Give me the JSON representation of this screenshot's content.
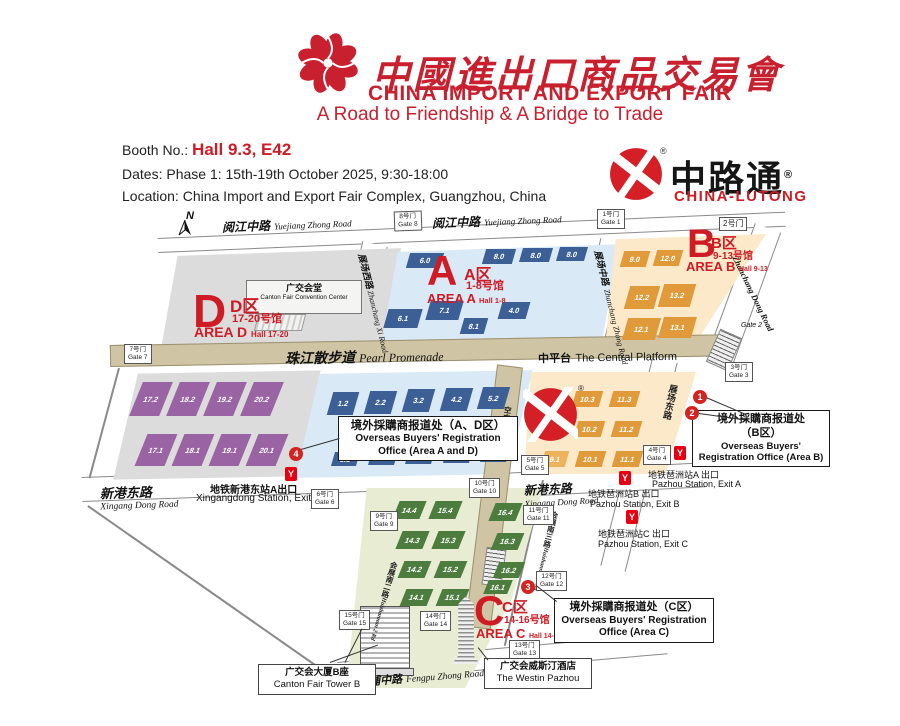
{
  "header": {
    "cn_title": "中國進出口商品交易會",
    "en_title": "CHINA IMPORT AND EXPORT FAIR",
    "slogan": "A Road to Friendship & A Bridge to Trade"
  },
  "info": {
    "booth_label": "Booth No.:",
    "booth_value": "Hall 9.3, E42",
    "dates": "Dates: Phase 1: 15th-19th October 2025, 9:30-18:00",
    "location": "Location: China Import and Export Fair Complex, Guangzhou, China"
  },
  "brand": {
    "cn": "中路通",
    "en": "CHINA-LUTONG",
    "reg": "®"
  },
  "map": {
    "compass": "N",
    "roads": {
      "yuejiang_cn": "阅江中路",
      "yuejiang_en": "Yuejiang Zhong Road",
      "promenade_cn": "珠江散步道",
      "promenade_en": "Pearl Promenade",
      "platform_cn": "中平台",
      "platform_en": "The Central Platform",
      "xingang_cn": "新港东路",
      "xingang_en": "Xingang Dong Road",
      "fengpu_cn": "凤浦中路",
      "fengpu_en": "Fengpu Zhong Road",
      "zx_cn": "展场西路",
      "zx_en": "Zhanchang Xi Road",
      "zz_cn": "展场中路",
      "zz_en": "Zhanchang Zhong Road",
      "zd_cn": "展场东路",
      "zd_en": "Zhanchang Dong Road",
      "flyover_cn": "空中走廊",
      "flyover_en": "Flyover",
      "hz2_cn": "会展南二路",
      "hz2_en": "Huizhannan 2 Rd",
      "hz3_cn": "会展南三路",
      "hz3_en": "Huizhannan 3 Rd"
    },
    "areas": {
      "a": {
        "letter": "A",
        "zone": "A区",
        "halls": "1-8号馆",
        "name": "AREA A",
        "range": "Hall 1-8"
      },
      "b": {
        "letter": "B",
        "zone": "B区",
        "halls": "9-13号馆",
        "name": "AREA B",
        "range": "Hall 9-13"
      },
      "c": {
        "letter": "C",
        "zone": "C区",
        "halls": "14-16号馆",
        "name": "AREA C",
        "range": "Hall 14-16"
      },
      "d": {
        "letter": "D",
        "zone": "D区",
        "halls": "17-20号馆",
        "name": "AREA D",
        "range": "Hall 17-20"
      }
    },
    "halls": {
      "a": [
        "6.0",
        "8.0",
        "8.0",
        "8.0",
        "6.1",
        "7.1",
        "8.1",
        "4.0",
        "1.2",
        "2.2",
        "3.2",
        "4.2",
        "5.2",
        "1.1",
        "2.1",
        "3.1",
        "4.1",
        "5.1"
      ],
      "b": [
        "9.0",
        "12.0",
        "12.2",
        "13.2",
        "12.1",
        "13.1",
        "9.3",
        "10.3",
        "11.3",
        "9.2",
        "10.2",
        "11.2",
        "9.1",
        "10.1",
        "11.1"
      ],
      "c": [
        "14.4",
        "15.4",
        "16.4",
        "14.3",
        "15.3",
        "16.3",
        "14.2",
        "15.2",
        "16.2",
        "14.1",
        "15.1",
        "16.1"
      ],
      "d": [
        "17.2",
        "18.2",
        "19.2",
        "20.2",
        "17.1",
        "18.1",
        "19.1",
        "20.1"
      ]
    },
    "gates": {
      "g1": {
        "cn": "1号门",
        "en": "Gate 1"
      },
      "g2": {
        "cn": "2号门",
        "en": "Gate 2"
      },
      "g3": {
        "cn": "3号门",
        "en": "Gate 3"
      },
      "g4": {
        "cn": "4号门",
        "en": "Gate 4"
      },
      "g5": {
        "cn": "5号门",
        "en": "Gate 5"
      },
      "g6": {
        "cn": "6号门",
        "en": "Gate 6"
      },
      "g7": {
        "cn": "7号门",
        "en": "Gate 7"
      },
      "g8": {
        "cn": "8号门",
        "en": "Gate 8"
      },
      "g9": {
        "cn": "9号门",
        "en": "Gate 9"
      },
      "g10": {
        "cn": "10号门",
        "en": "Gate 10"
      },
      "g11": {
        "cn": "11号门",
        "en": "Gate 11"
      },
      "g12": {
        "cn": "12号门",
        "en": "Gate 12"
      },
      "g13": {
        "cn": "13号门",
        "en": "Gate 13"
      },
      "g14": {
        "cn": "14号门",
        "en": "Gate 14"
      },
      "g15": {
        "cn": "15号门",
        "en": "Gate 15"
      }
    },
    "buildings": {
      "convention_cn": "广交会堂",
      "convention_en": "Canton Fair Convention Center",
      "tower_b_cn": "广交会大厦B座",
      "tower_b_en": "Canton Fair Tower B",
      "westin_cn": "广交会威斯汀酒店",
      "westin_en": "The Westin Pazhou"
    },
    "registration": {
      "ad_cn": "境外採購商报道处（A、D区）",
      "ad_en1": "Overseas Buyers' Registration",
      "ad_en2": "Office (Area A and D)",
      "b_cn": "境外採購商报道处",
      "b_cn2": "（B区）",
      "b_en1": "Overseas Buyers'",
      "b_en2": "Registration Office (Area B)",
      "c_cn": "境外採購商报道处（C区）",
      "c_en1": "Overseas Buyers' Registration",
      "c_en2": "Office (Area C)"
    },
    "metro": {
      "glyph": "Y",
      "xingang_cn": "地铁新港东站A出口",
      "xingang_en": "Xingangdong Station, Exit A",
      "pa_cn": "地铁琶洲站A 出口",
      "pa_en": "Pazhou Station, Exit A",
      "pb_cn": "地铁琶洲站B 出口",
      "pb_en": "Pazhou Station, Exit B",
      "pc_cn": "地铁琶洲站C 出口",
      "pc_en": "Pazhou Station, Exit C"
    },
    "markers": {
      "m1": "1",
      "m2": "2",
      "m3": "3",
      "m4": "4"
    }
  },
  "colors": {
    "accent": "#cf1b24",
    "hall_a": "#3c6095",
    "hall_b": "#e09a39",
    "hall_c": "#4c7c3e",
    "hall_d": "#9a63a4",
    "promenade": "#cfc5a4",
    "metro_red": "#e60012"
  }
}
